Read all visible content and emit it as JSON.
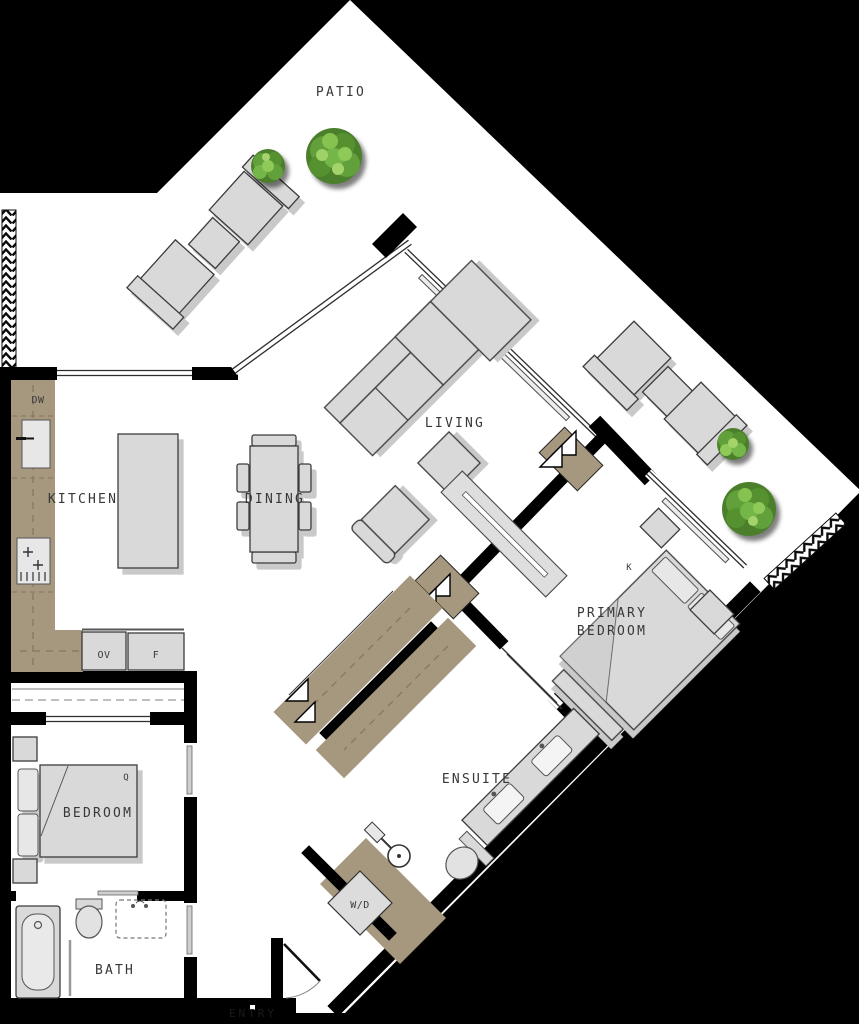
{
  "plan_type": "apartment-floor-plan",
  "labels": {
    "patio": "PATIO",
    "living": "LIVING",
    "kitchen": "KITCHEN",
    "dining": "DINING",
    "primary_line1": "PRIMARY",
    "primary_line2": "BEDROOM",
    "ensuite": "ENSUITE",
    "bedroom": "BEDROOM",
    "bath": "BATH",
    "entry": "ENTRY",
    "dishwasher": "DW",
    "oven": "OV",
    "fridge": "F",
    "washer_dryer": "W/D",
    "king_bed": "K",
    "queen_bed": "Q"
  },
  "colors": {
    "background": "#000000",
    "floor": "#ffffff",
    "wall": "#000000",
    "cabinetry_tan": "#a6977f",
    "furniture_gray": "#d9d9d9",
    "furniture_stroke": "#3c3c3c",
    "label_text": "#383838",
    "tree_dark": "#4c7f2c",
    "tree_mid": "#61a03a",
    "tree_light": "#8fca58"
  }
}
